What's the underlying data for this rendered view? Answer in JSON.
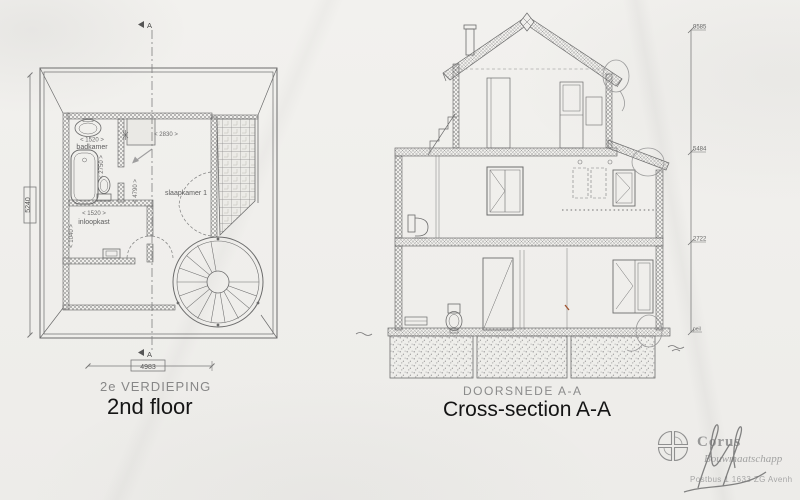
{
  "colors": {
    "paper": "#f1f0ed",
    "ink": "#6c6c6c",
    "print_label": "#878787",
    "annotation": "#151515",
    "stamp_gray": "#9c9c9c",
    "red_mark": "#a0522d"
  },
  "floor_plan": {
    "print_title": "2e VERDIEPING",
    "annotation_title": "2nd floor",
    "section_letter_top": "A",
    "section_letter_bottom": "A",
    "rooms": {
      "badkamer": {
        "label": "badkamer",
        "width_dim": "< 1520 >",
        "depth_dim": "< 2750 >"
      },
      "inloopkast": {
        "label": "inloopkast",
        "width_dim": "< 1520 >",
        "depth_dim": "< 1040 >"
      },
      "slaapkamer": {
        "label": "slaapkamer 1",
        "depth_dim": "< 4790 >",
        "width_dim": "< 2830 >"
      }
    },
    "overall_width_dim": "4983",
    "overall_depth_dim": "5240"
  },
  "cross_section": {
    "print_title": "DOORSNEDE A-A",
    "annotation_title": "Cross-section A-A",
    "elevation_marks": [
      {
        "value": "9585"
      },
      {
        "value": "5484"
      },
      {
        "value": "2722"
      },
      {
        "value": "peil"
      }
    ]
  },
  "stamp": {
    "company": "Corus",
    "tagline": "Bouwmaatschapp",
    "address": "Postbus 1   1633 ZG  Avenh"
  }
}
